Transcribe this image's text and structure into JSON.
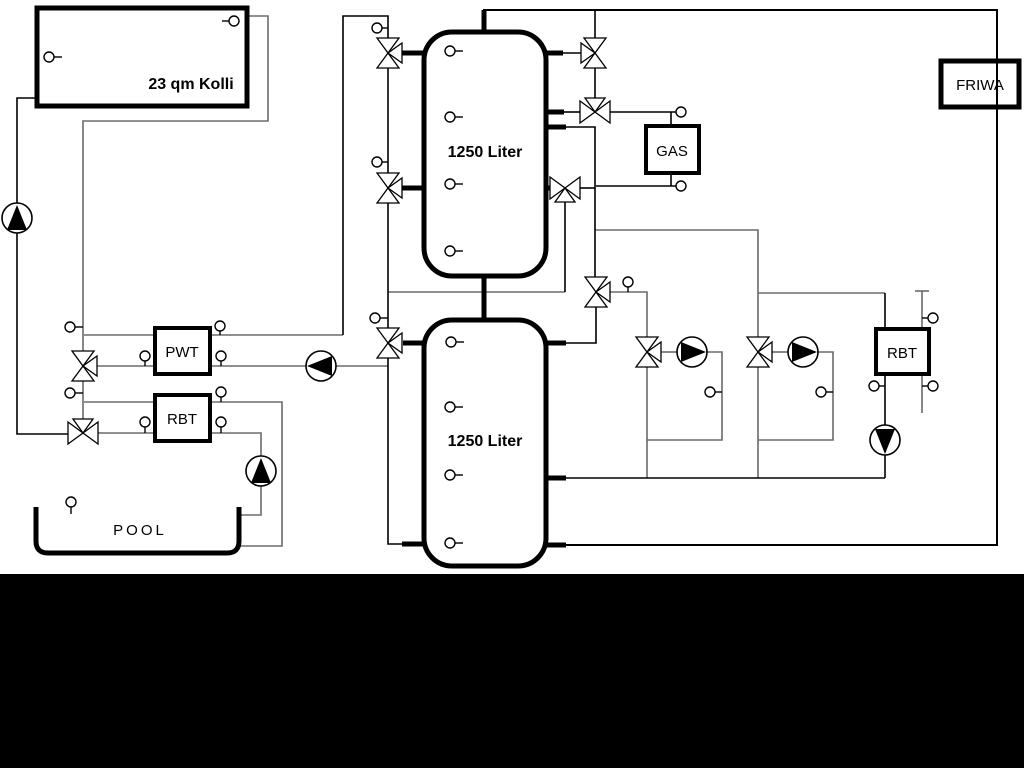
{
  "labels": {
    "collector": "23 qm Kolli",
    "tank_top": "1250 Liter",
    "tank_bottom": "1250 Liter",
    "gas": "GAS",
    "friwa": "FRIWA",
    "pwt": "PWT",
    "rbt_left": "RBT",
    "rbt_right": "RBT",
    "pool": "POOL"
  },
  "colors": {
    "pipe_primary": "#000000",
    "pipe_secondary": "#6b6b6b",
    "background": "#ffffff",
    "bottom_mask": "#000000"
  }
}
